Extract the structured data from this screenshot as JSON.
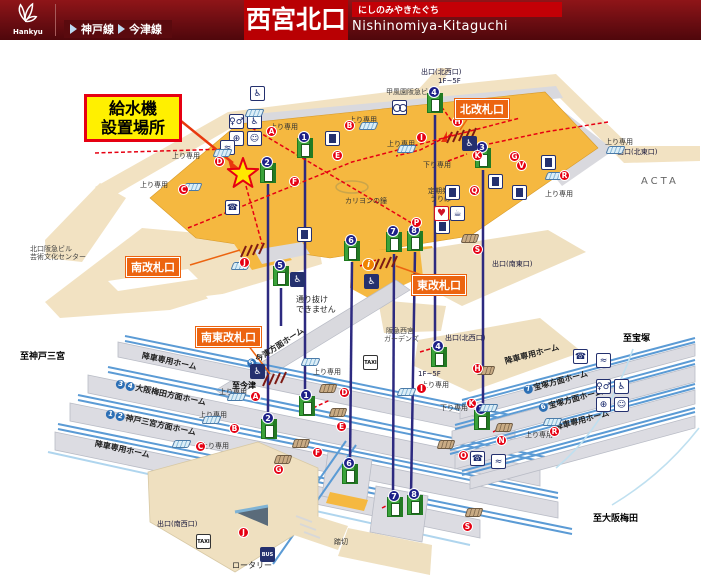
{
  "header": {
    "brand": "Hankyu",
    "lines": [
      "神戸線",
      "今津線"
    ],
    "title": "西宮北口",
    "title_kana": "にしのみやきたぐち",
    "title_romaji": "Nishinomiya-Kitaguchi"
  },
  "callout": {
    "line1": "給水機",
    "line2": "設置場所"
  },
  "map": {
    "gates": [
      {
        "id": "north",
        "label": "北改札口",
        "x": 455,
        "y": 99
      },
      {
        "id": "south",
        "label": "南改札口",
        "x": 126,
        "y": 257
      },
      {
        "id": "east",
        "label": "東改札口",
        "x": 412,
        "y": 275
      },
      {
        "id": "southeast",
        "label": "南東改札口",
        "x": 196,
        "y": 327
      }
    ],
    "text_labels": [
      {
        "t": "出口(北西口)",
        "x": 421,
        "y": 67,
        "cls": "ex"
      },
      {
        "t": "1F~5F",
        "x": 438,
        "y": 77,
        "cls": "ex"
      },
      {
        "t": "甲風園阪急ビル",
        "x": 386,
        "y": 87,
        "cls": "bld"
      },
      {
        "t": "出口(北東口)",
        "x": 617,
        "y": 147,
        "cls": "ex"
      },
      {
        "t": "ACTA",
        "x": 641,
        "y": 176,
        "cls": "acta"
      },
      {
        "t": "北口阪急ビル",
        "x": 30,
        "y": 244,
        "cls": "bld"
      },
      {
        "t": "芸術文化センター",
        "x": 30,
        "y": 252,
        "cls": "bld"
      },
      {
        "t": "カリヨンの鐘",
        "x": 345,
        "y": 196,
        "cls": "sm"
      },
      {
        "t": "定期券",
        "x": 428,
        "y": 186,
        "cls": "sm"
      },
      {
        "t": "うりば",
        "x": 430,
        "y": 194,
        "cls": "sm"
      },
      {
        "t": "通り抜け",
        "x": 296,
        "y": 294,
        "cls": "note"
      },
      {
        "t": "できません",
        "x": 296,
        "y": 304,
        "cls": "note"
      },
      {
        "t": "出口(南東口)",
        "x": 492,
        "y": 259,
        "cls": "ex"
      },
      {
        "t": "阪急西宮",
        "x": 386,
        "y": 326,
        "cls": "bld"
      },
      {
        "t": "ガーデンズ",
        "x": 384,
        "y": 334,
        "cls": "bld"
      },
      {
        "t": "出口(北西口)",
        "x": 445,
        "y": 333,
        "cls": "ex"
      },
      {
        "t": "1F~5F",
        "x": 418,
        "y": 370,
        "cls": "ex"
      },
      {
        "t": "至宝塚",
        "x": 623,
        "y": 331,
        "cls": "dir"
      },
      {
        "t": "至神戸三宮",
        "x": 20,
        "y": 349,
        "cls": "dir"
      },
      {
        "t": "至今津",
        "x": 232,
        "y": 380,
        "cls": "dir2"
      },
      {
        "t": "至大阪梅田",
        "x": 593,
        "y": 511,
        "cls": "dir"
      },
      {
        "t": "出口(南西口)",
        "x": 157,
        "y": 519,
        "cls": "ex"
      },
      {
        "t": "ロータリー",
        "x": 232,
        "y": 560,
        "cls": "note"
      },
      {
        "t": "踏切",
        "x": 334,
        "y": 537,
        "cls": "sm"
      },
      {
        "t": "上り専用",
        "x": 270,
        "y": 122,
        "cls": "sm"
      },
      {
        "t": "上り専用",
        "x": 172,
        "y": 151,
        "cls": "sm"
      },
      {
        "t": "上り専用",
        "x": 140,
        "y": 180,
        "cls": "sm"
      },
      {
        "t": "上り専用",
        "x": 349,
        "y": 115,
        "cls": "sm"
      },
      {
        "t": "上り専用",
        "x": 387,
        "y": 139,
        "cls": "sm"
      },
      {
        "t": "上り専用",
        "x": 605,
        "y": 137,
        "cls": "sm"
      },
      {
        "t": "上り専用",
        "x": 545,
        "y": 189,
        "cls": "sm"
      },
      {
        "t": "上り専用",
        "x": 219,
        "y": 387,
        "cls": "sm"
      },
      {
        "t": "上り専用",
        "x": 199,
        "y": 410,
        "cls": "sm"
      },
      {
        "t": "上り専用",
        "x": 201,
        "y": 441,
        "cls": "sm"
      },
      {
        "t": "上り専用",
        "x": 313,
        "y": 367,
        "cls": "sm"
      },
      {
        "t": "上り専用",
        "x": 421,
        "y": 380,
        "cls": "sm"
      },
      {
        "t": "上り専用",
        "x": 525,
        "y": 430,
        "cls": "sm"
      },
      {
        "t": "下り専用",
        "x": 423,
        "y": 160,
        "cls": "sm"
      },
      {
        "t": "下り専用",
        "x": 440,
        "y": 403,
        "cls": "sm"
      }
    ],
    "platform_labels": [
      {
        "t": "降車専用ホーム",
        "tr": [],
        "x": 142,
        "y": 350,
        "r": 12
      },
      {
        "t": "大阪梅田方面ホーム",
        "tr": [
          "3",
          "4"
        ],
        "x": 116,
        "y": 378,
        "r": 12
      },
      {
        "t": "神戸三宮方面ホーム",
        "tr": [
          "1",
          "2"
        ],
        "x": 106,
        "y": 408,
        "r": 12
      },
      {
        "t": "降車専用ホーム",
        "tr": [],
        "x": 95,
        "y": 438,
        "r": 12
      },
      {
        "t": "降車専用ホーム",
        "tr": [],
        "x": 505,
        "y": 356,
        "r": -15
      },
      {
        "t": "宝塚方面ホーム",
        "tr": [
          "7"
        ],
        "x": 524,
        "y": 385,
        "r": -15
      },
      {
        "t": "宝塚方面ホーム",
        "tr": [
          "6"
        ],
        "x": 539,
        "y": 403,
        "r": -15
      },
      {
        "t": "降車専用ホーム",
        "tr": [],
        "x": 555,
        "y": 422,
        "r": -15
      },
      {
        "t": "今津方面ホーム",
        "tr": [
          "5"
        ],
        "x": 248,
        "y": 360,
        "r": -33
      }
    ],
    "letters": [
      {
        "t": "A",
        "x": 266,
        "y": 126
      },
      {
        "t": "B",
        "x": 344,
        "y": 120
      },
      {
        "t": "C",
        "x": 178,
        "y": 184
      },
      {
        "t": "D",
        "x": 214,
        "y": 156
      },
      {
        "t": "E",
        "x": 332,
        "y": 150
      },
      {
        "t": "F",
        "x": 289,
        "y": 176
      },
      {
        "t": "G",
        "x": 509,
        "y": 151
      },
      {
        "t": "H",
        "x": 452,
        "y": 116
      },
      {
        "t": "I",
        "x": 416,
        "y": 132
      },
      {
        "t": "K",
        "x": 472,
        "y": 150
      },
      {
        "t": "Q",
        "x": 469,
        "y": 185
      },
      {
        "t": "P",
        "x": 411,
        "y": 217
      },
      {
        "t": "R",
        "x": 559,
        "y": 170
      },
      {
        "t": "S",
        "x": 472,
        "y": 244
      },
      {
        "t": "V",
        "x": 516,
        "y": 160
      },
      {
        "t": "J",
        "x": 239,
        "y": 257
      },
      {
        "t": "A",
        "x": 250,
        "y": 391
      },
      {
        "t": "B",
        "x": 229,
        "y": 423
      },
      {
        "t": "C",
        "x": 195,
        "y": 441
      },
      {
        "t": "D",
        "x": 339,
        "y": 387
      },
      {
        "t": "E",
        "x": 336,
        "y": 421
      },
      {
        "t": "F",
        "x": 312,
        "y": 447
      },
      {
        "t": "G",
        "x": 273,
        "y": 464
      },
      {
        "t": "H",
        "x": 472,
        "y": 363
      },
      {
        "t": "I",
        "x": 416,
        "y": 383
      },
      {
        "t": "J",
        "x": 238,
        "y": 527
      },
      {
        "t": "K",
        "x": 466,
        "y": 398
      },
      {
        "t": "N",
        "x": 496,
        "y": 435
      },
      {
        "t": "O",
        "x": 458,
        "y": 450
      },
      {
        "t": "R",
        "x": 549,
        "y": 426
      },
      {
        "t": "S",
        "x": 462,
        "y": 521
      }
    ],
    "elevators": [
      {
        "n": "1",
        "x": 297,
        "y": 138
      },
      {
        "n": "2",
        "x": 260,
        "y": 163
      },
      {
        "n": "3",
        "x": 475,
        "y": 148
      },
      {
        "n": "4",
        "x": 427,
        "y": 93
      },
      {
        "n": "5",
        "x": 273,
        "y": 266
      },
      {
        "n": "6",
        "x": 344,
        "y": 241
      },
      {
        "n": "7",
        "x": 386,
        "y": 232
      },
      {
        "n": "8",
        "x": 407,
        "y": 231
      },
      {
        "n": "1",
        "x": 299,
        "y": 396
      },
      {
        "n": "2",
        "x": 261,
        "y": 419
      },
      {
        "n": "3",
        "x": 474,
        "y": 410
      },
      {
        "n": "4",
        "x": 431,
        "y": 347
      },
      {
        "n": "6",
        "x": 342,
        "y": 464
      },
      {
        "n": "7",
        "x": 387,
        "y": 497
      },
      {
        "n": "8",
        "x": 407,
        "y": 495
      }
    ],
    "icons": [
      {
        "type": "toilet",
        "g": "♀♂",
        "x": 229,
        "y": 114
      },
      {
        "type": "wheelchair",
        "g": "♿",
        "x": 247,
        "y": 114
      },
      {
        "type": "ostomate",
        "g": "⊕",
        "x": 229,
        "y": 131
      },
      {
        "type": "baby",
        "g": "☺",
        "x": 247,
        "y": 131
      },
      {
        "type": "toilet",
        "g": "♀♂",
        "x": 596,
        "y": 379
      },
      {
        "type": "wheelchair",
        "g": "♿",
        "x": 614,
        "y": 379
      },
      {
        "type": "ostomate",
        "g": "⊕",
        "x": 596,
        "y": 397
      },
      {
        "type": "baby",
        "g": "☺",
        "x": 614,
        "y": 397
      },
      {
        "type": "accpole",
        "g": "♿",
        "x": 250,
        "y": 86
      },
      {
        "type": "phone",
        "g": "☎",
        "x": 225,
        "y": 200
      },
      {
        "type": "phone",
        "g": "☎",
        "x": 470,
        "y": 451
      },
      {
        "type": "phone",
        "g": "☎",
        "x": 573,
        "y": 349
      },
      {
        "type": "water",
        "g": "≈",
        "x": 220,
        "y": 140
      },
      {
        "type": "water",
        "g": "≈",
        "x": 491,
        "y": 454
      },
      {
        "type": "water",
        "g": "≈",
        "x": 596,
        "y": 353
      },
      {
        "type": "tm",
        "g": "",
        "x": 325,
        "y": 131
      },
      {
        "type": "tm",
        "g": "",
        "x": 445,
        "y": 185
      },
      {
        "type": "tm",
        "g": "",
        "x": 488,
        "y": 174
      },
      {
        "type": "tm",
        "g": "",
        "x": 512,
        "y": 185
      },
      {
        "type": "tm",
        "g": "",
        "x": 435,
        "y": 219
      },
      {
        "type": "tm",
        "g": "",
        "x": 541,
        "y": 155
      },
      {
        "type": "tm",
        "g": "",
        "x": 297,
        "y": 227
      },
      {
        "type": "aed",
        "g": "♥",
        "x": 434,
        "y": 206
      },
      {
        "type": "vend",
        "g": "☕",
        "x": 450,
        "y": 206
      },
      {
        "type": "info",
        "g": "i",
        "x": 362,
        "y": 258
      },
      {
        "type": "widegate",
        "g": "♿",
        "x": 462,
        "y": 136
      },
      {
        "type": "widegate",
        "g": "♿",
        "x": 290,
        "y": 272
      },
      {
        "type": "widegate",
        "g": "♿",
        "x": 364,
        "y": 274
      },
      {
        "type": "widegate",
        "g": "♿",
        "x": 250,
        "y": 364
      },
      {
        "type": "bike",
        "g": "",
        "x": 392,
        "y": 100
      },
      {
        "type": "taxi",
        "g": "TAXI",
        "x": 196,
        "y": 534
      },
      {
        "type": "taxi",
        "g": "TAXI",
        "x": 363,
        "y": 355
      },
      {
        "type": "bus",
        "g": "BUS",
        "x": 260,
        "y": 547
      },
      {
        "type": "esc",
        "g": "",
        "x": 246,
        "y": 109
      },
      {
        "type": "esc",
        "g": "",
        "x": 214,
        "y": 149
      },
      {
        "type": "esc",
        "g": "",
        "x": 184,
        "y": 183
      },
      {
        "type": "esc",
        "g": "",
        "x": 360,
        "y": 122
      },
      {
        "type": "esc",
        "g": "",
        "x": 398,
        "y": 145
      },
      {
        "type": "esc",
        "g": "",
        "x": 546,
        "y": 172
      },
      {
        "type": "esc",
        "g": "",
        "x": 607,
        "y": 146
      },
      {
        "type": "esc",
        "g": "",
        "x": 302,
        "y": 358
      },
      {
        "type": "esc",
        "g": "",
        "x": 228,
        "y": 393
      },
      {
        "type": "esc",
        "g": "",
        "x": 203,
        "y": 416
      },
      {
        "type": "esc",
        "g": "",
        "x": 173,
        "y": 440
      },
      {
        "type": "esc",
        "g": "",
        "x": 398,
        "y": 388
      },
      {
        "type": "esc",
        "g": "",
        "x": 480,
        "y": 404
      },
      {
        "type": "esc",
        "g": "",
        "x": 544,
        "y": 418
      },
      {
        "type": "esc",
        "g": "",
        "x": 232,
        "y": 262
      },
      {
        "type": "stairs",
        "g": "",
        "x": 478,
        "y": 366
      },
      {
        "type": "stairs",
        "g": "",
        "x": 320,
        "y": 384
      },
      {
        "type": "stairs",
        "g": "",
        "x": 330,
        "y": 408
      },
      {
        "type": "stairs",
        "g": "",
        "x": 293,
        "y": 439
      },
      {
        "type": "stairs",
        "g": "",
        "x": 275,
        "y": 455
      },
      {
        "type": "stairs",
        "g": "",
        "x": 496,
        "y": 423
      },
      {
        "type": "stairs",
        "g": "",
        "x": 438,
        "y": 440
      },
      {
        "type": "stairs",
        "g": "",
        "x": 466,
        "y": 508
      },
      {
        "type": "stairs",
        "g": "",
        "x": 462,
        "y": 234
      }
    ]
  }
}
